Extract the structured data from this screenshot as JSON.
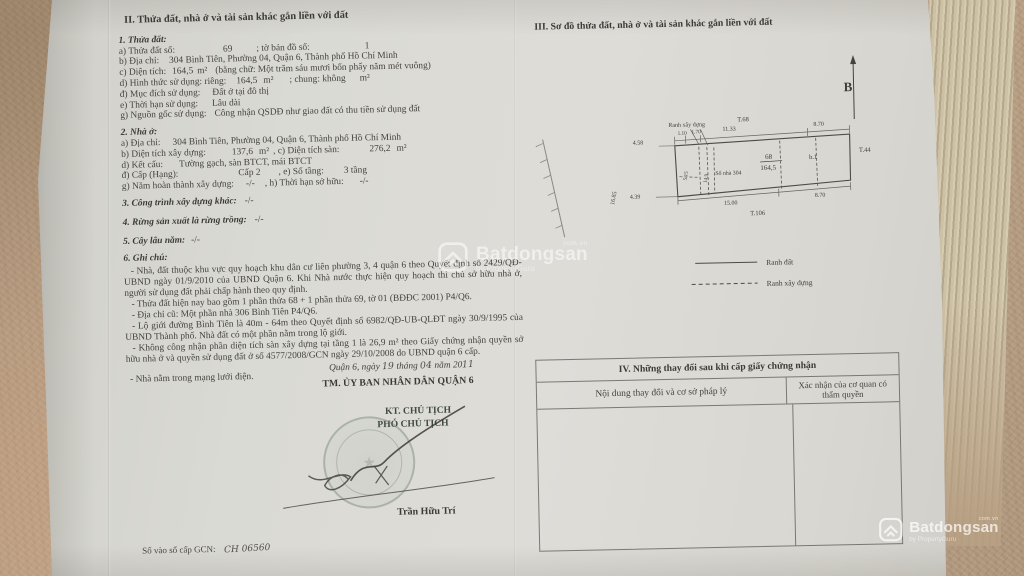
{
  "watermark": {
    "brand": "Batdongsan",
    "tld": "com.vn",
    "byline": "by PropertyGuru"
  },
  "left_page": {
    "heading": "II. Thửa đất, nhà ở và tài sản khác gắn liền với đất",
    "sec1": {
      "title": "1. Thửa đất:",
      "a_label": "a) Thửa đất số:",
      "a_value": "69",
      "a2_label": "; tờ bản đồ số:",
      "a2_value": "1",
      "b_label": "b) Địa chỉ:",
      "b_value": "304 Bình Tiên, Phường 04, Quận 6, Thành phố Hồ Chí Minh",
      "c_label": "c) Diện tích:",
      "c_value": "164,5",
      "c_unit": "m²",
      "c_words": "(bằng chữ: Một trăm sáu mươi bốn phẩy năm mét vuông)",
      "d_label": "d) Hình thức sử dụng: riêng:",
      "d_value": "164,5",
      "d_unit": "m²",
      "d2_label": "; chung: không",
      "d2_unit": "m²",
      "dd_label": "đ) Mục đích sử dụng:",
      "dd_value": "Đất ở tại đô thị",
      "e_label": "e) Thời hạn sử dụng:",
      "e_value": "Lâu dài",
      "g_label": "g) Nguồn gốc sử dụng:",
      "g_value": "Công nhận QSDĐ như giao đất có thu tiền sử dụng đất"
    },
    "sec2": {
      "title": "2. Nhà ở:",
      "a_label": "a) Địa chỉ:",
      "a_value": "304 Bình Tiên, Phường 04, Quận 6, Thành phố Hồ Chí Minh",
      "b_label": "b) Diện tích xây dựng:",
      "b_value": "137,6",
      "b_unit": "m²",
      "c_label": ", c) Diện tích sàn:",
      "c_value": "276,2",
      "c_unit": "m²",
      "d_label": "d) Kết cấu:",
      "d_value": "Tường gạch, sàn BTCT, mái BTCT",
      "dd_label": "đ) Cấp (Hạng):",
      "dd_value": "Cấp 2",
      "e_label": ", e) Số tầng:",
      "e_value": "3 tầng",
      "g_label": "g) Năm hoàn thành xây dựng:",
      "g_value": "-/-",
      "h_label": ", h) Thời hạn sở hữu:",
      "h_value": "-/-"
    },
    "sec3_title": "3. Công trình xây dựng khác:",
    "sec3_value": "-/-",
    "sec4_title": "4. Rừng sản xuất là rừng trồng:",
    "sec4_value": "-/-",
    "sec5_title": "5. Cây lâu năm:",
    "sec5_value": "-/-",
    "sec6_title": "6. Ghi chú:",
    "notes": [
      "- Nhà, đất thuộc khu vực quy hoạch khu dân cư liên phường 3, 4 quận 6 theo Quyết định số 2429/QĐ-UBND ngày 01/9/2010 của UBND Quận 6. Khi Nhà nước thực hiện quy hoạch thì chủ sở hữu nhà ở, người sử dụng đất phải chấp hành theo quy định.",
      "- Thửa đất hiện nay bao gồm 1 phần thửa 68 + 1 phần thửa 69, tờ 01 (BĐĐC 2001) P4/Q6.",
      "- Địa chỉ cũ: Một phần nhà 306 Bình Tiên P4/Q6.",
      "- Lộ giới đường Bình Tiên là 40m - 64m theo Quyết định số 6982/QĐ-UB-QLĐT ngày 30/9/1995 của UBND Thành phố. Nhà đất có một phần nằm trong lộ giới.",
      "- Không công nhận phần diện tích sàn xây dựng tại tầng 1 là 26,9 m² theo Giấy chứng nhận quyền sở hữu nhà ở và quyền sử dụng đất ở số 4577/2008/GCN ngày 29/10/2008 do UBND quận 6 cấp.",
      "- Nhà nằm trong mạng lưới điện."
    ],
    "signing": {
      "place_date_prefix": "Quận 6, ngày",
      "day": "19",
      "date_mid1": "tháng",
      "month": "04",
      "date_mid2": "năm 20",
      "year": "11",
      "authority": "TM. ỦY BAN NHÂN DÂN QUẬN 6",
      "title1": "KT. CHỦ TỊCH",
      "title2": "PHÓ CHỦ TỊCH",
      "signer": "Trần Hữu Trí"
    },
    "gcn_label": "Số vào sổ cấp GCN:",
    "gcn_value": "CH 06560"
  },
  "right_page": {
    "heading": "III. Sơ đồ thửa đất, nhà ở và tài sản khác gắn liền với đất",
    "diagram": {
      "north_label": "B",
      "build_boundary_label": "Ranh xây dựng",
      "parcel_top": "T.68",
      "parcel_right": "T.44",
      "parcel_bottom": "T.106",
      "plot_number": "68",
      "plot_area": "164,5",
      "house_number": "Số nhà 304",
      "sub_label": "b.1",
      "dims": {
        "top_small_1": "1.10",
        "top_small_2": "1.70",
        "top_main": "11.33",
        "top_right": "8.70",
        "left_top": "4.58",
        "left_bottom": "4.39",
        "left_side": "16.85",
        "inner_1": "5.15",
        "inner_2": "14.9",
        "bottom_main": "15.00",
        "bottom_right": "8.70"
      }
    },
    "legend": {
      "land_boundary": "Ranh đất",
      "build_boundary": "Ranh xây dựng"
    },
    "table": {
      "title": "IV. Những thay đổi sau khi cấp giấy chứng nhận",
      "col1": "Nội dung thay đổi và cơ sở pháp lý",
      "col2": "Xác nhận của cơ quan có thẩm quyền"
    }
  }
}
